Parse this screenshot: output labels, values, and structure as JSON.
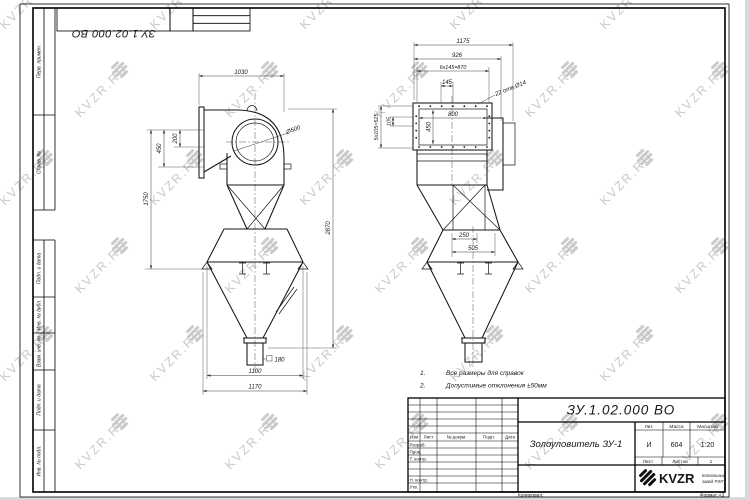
{
  "sheet": {
    "designation_top": "ЗУ.1.02.000 ВО",
    "copied": "Копировал:",
    "format": "Формат А3",
    "margin_labels": {
      "perv": "Перв. примен.",
      "sprav": "Справ. №",
      "podp1": "Подп. и дата",
      "inv_dubl": "Инв. № дубл.",
      "vzam": "Взам. инв. №",
      "podp2": "Подп. и дата",
      "inv_podl": "Инв. № подл."
    }
  },
  "watermark": {
    "text": "KVZR.RU"
  },
  "notes": {
    "n1": "1.",
    "t1": "Все размеры для справок",
    "n2": "2.",
    "t2": "Допустимые отклонения ±50мм"
  },
  "dims": {
    "front": {
      "w_top": "1030",
      "h200": "200",
      "h450": "450",
      "h1750": "1750",
      "h2870": "2870",
      "dia": "Ø500",
      "sq": "180",
      "w1100": "1100",
      "w1170": "1170"
    },
    "side": {
      "w1175": "1175",
      "w926": "926",
      "w870": "6x145=870",
      "w145": "145",
      "holes": "22 отв.Ø14",
      "w800": "800",
      "h450": "450",
      "h525": "5x105=525",
      "h105": "105",
      "w250": "250",
      "w505": "505"
    }
  },
  "title_block": {
    "designation": "ЗУ.1.02.000 ВО",
    "name": "Золоуловитель ЗУ-1",
    "cols": {
      "izm": "Изм",
      "list": "Лист",
      "doc": "№ докум.",
      "podp": "Подп.",
      "data": "Дата"
    },
    "rows": {
      "razrab": "Разраб.",
      "prov": "Пров.",
      "tkontr": "Т. контр.",
      "nkontr": "Н. контр.",
      "utv": "Утв."
    },
    "lit_label": "Лит.",
    "mass_label": "Масса",
    "scale_label": "Масштаб",
    "lit": "И",
    "mass": "604",
    "scale": "1:20",
    "sheet_label": "Лист",
    "sheets_label": "Листов",
    "sheets_value": "1",
    "logo": "KVZR",
    "logo_line1": "Котельный",
    "logo_line2": "завод РЭП"
  }
}
